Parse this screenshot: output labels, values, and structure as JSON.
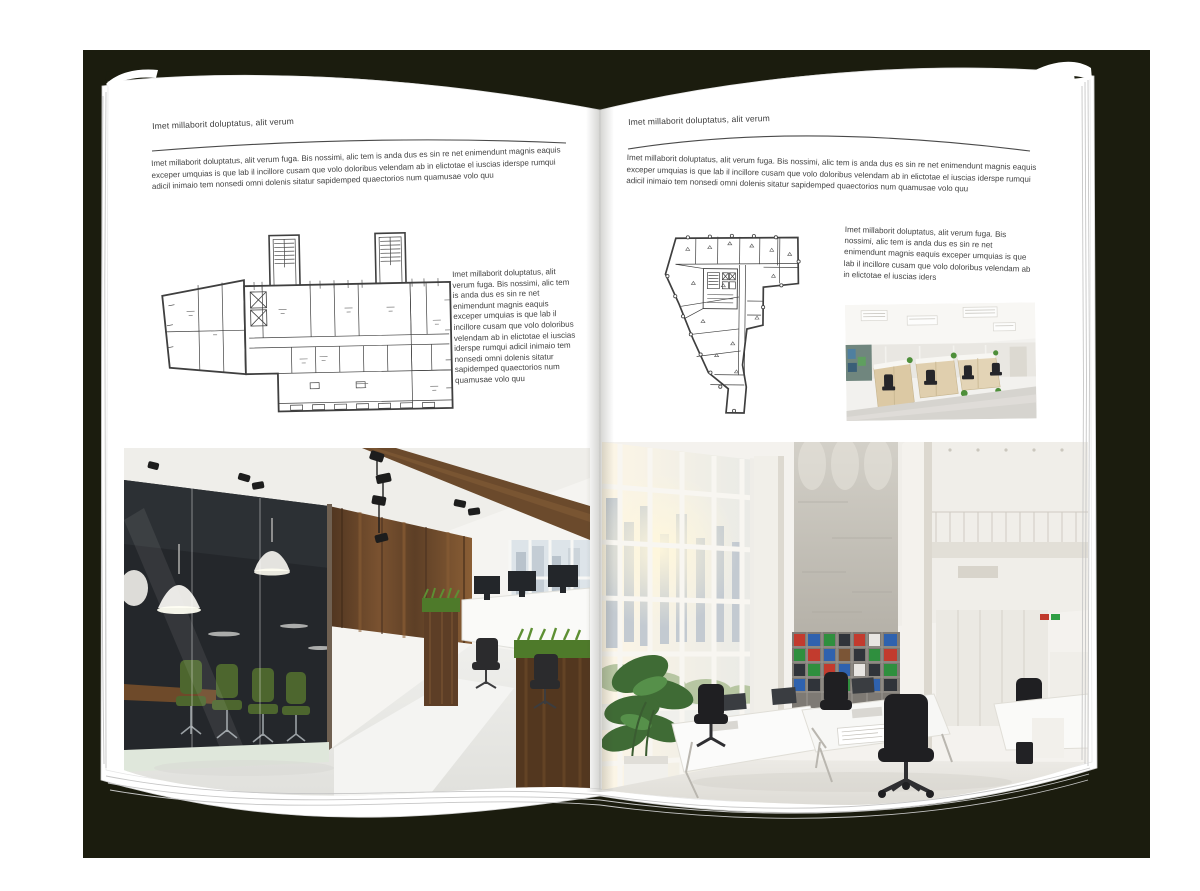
{
  "colors": {
    "backdrop": "#1b1c0e",
    "page": "#ffffff",
    "text": "#424242",
    "rule": "#4a4a4a",
    "wood": "#6b4a2c",
    "chair_green": "#4d662e",
    "plan_ink": "#3f3f3f"
  },
  "left_page": {
    "header": "Imet millaborit doluptatus, alit verum",
    "intro": "Imet millaborit doluptatus, alit verum fuga. Bis nossimi, alic tem is anda dus es sin re net enimendunt magnis eaquis exceper umquias is que lab il incillore cusam que volo doloribus velendam ab in elictotae el iuscias iderspe rumqui adicil inimaio tem nonsedi omni dolenis sitatur sapidemped quaectorios num quamusae volo quu",
    "caption": "Imet millaborit doluptatus, alit verum fuga. Bis nossimi, alic tem is anda dus es sin re net enimendunt magnis eaquis exceper umquias is que lab il incillore cusam que volo doloribus velendam ab in elictotae el iuscias iderspe rumqui adicil inimaio tem nonsedi omni dolenis sitatur sapidemped quaectorios num quamusae volo quu",
    "floorplan": "rectangular-building-floor-plan-with-two-stair-towers",
    "photo": "office-interior-glass-meeting-room-wood-walls"
  },
  "right_page": {
    "header": "Imet millaborit doluptatus, alit verum",
    "intro": "Imet millaborit doluptatus, alit verum fuga. Bis nossimi, alic tem is anda dus es sin re net enimendunt magnis eaquis exceper umquias is que lab il incillore cusam que volo doloribus velendam ab in elictotae el iuscias iderspe rumqui adicil inimaio tem nonsedi omni dolenis sitatur sapidemped quaectorios num quamusae volo quu",
    "caption": "Imet millaborit doluptatus, alit verum fuga. Bis nossimi, alic tem is anda dus es sin re net enimendunt magnis eaquis exceper umquias is que lab il incillore cusam que volo doloribus velendam ab in elictotae el iuscias iders",
    "floorplan": "irregular-tapering-building-floor-plan",
    "photo_small": "open-plan-office-cubicles-wood-cabinets",
    "photo": "bright-double-height-white-office-atrium"
  }
}
